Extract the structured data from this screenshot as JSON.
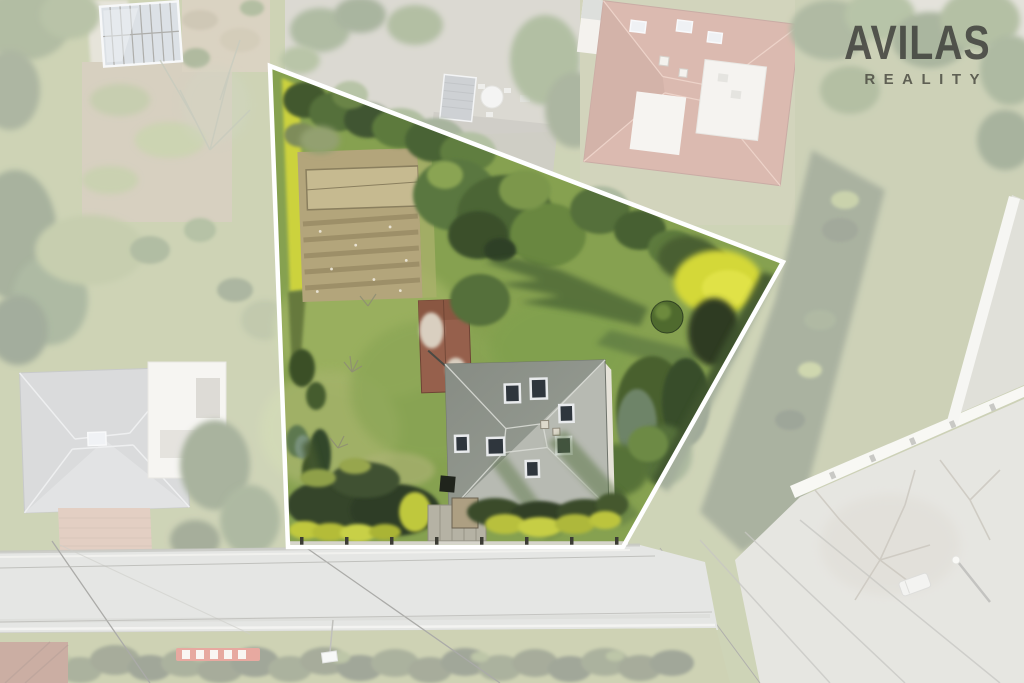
{
  "watermark": {
    "brand": "AVILAS",
    "tagline": "REALITY",
    "color": "#3b3b38"
  },
  "boundary": {
    "points": "270,66 783,262 623,547 288,547",
    "fade_path": "M0,0 L1024,0 L1024,683 L0,683 Z M270,66 L783,262 L623,547 L288,547 Z",
    "stroke_color": "#ffffff",
    "stroke_width": 4.5,
    "fade_color": "#ffffff",
    "fade_opacity": 0.52
  },
  "palette": {
    "lawn_green": "#86a150",
    "canopy_green": "#55703a",
    "hedge_yellow": "#ccd23c",
    "roof_gray": "#b7bab2",
    "roof_terracotta": "#b5705a",
    "road_gray": "#c9cbc7",
    "soil_tan": "#b3a57b",
    "brick_red": "#96604c"
  }
}
